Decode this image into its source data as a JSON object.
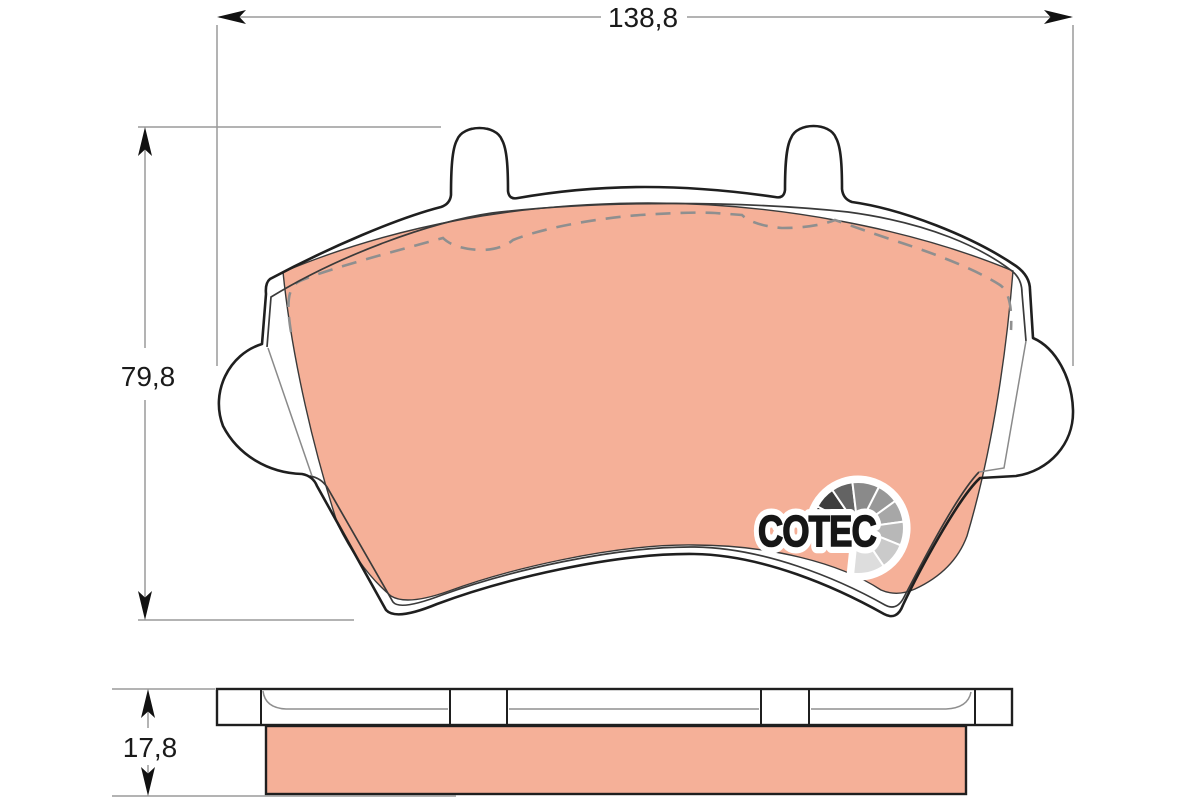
{
  "drawing": {
    "dimensions": {
      "width_label": "138,8",
      "height_label": "79,8",
      "thickness_label": "17,8"
    },
    "logo": {
      "text": "COTEC"
    },
    "colors": {
      "friction_material": "#f5b098",
      "outline": "#1f1f1f",
      "dimension_line": "#9a9a9a",
      "dashed_line": "#8f8f8f",
      "logo_black": "#161616",
      "background": "#ffffff"
    }
  }
}
